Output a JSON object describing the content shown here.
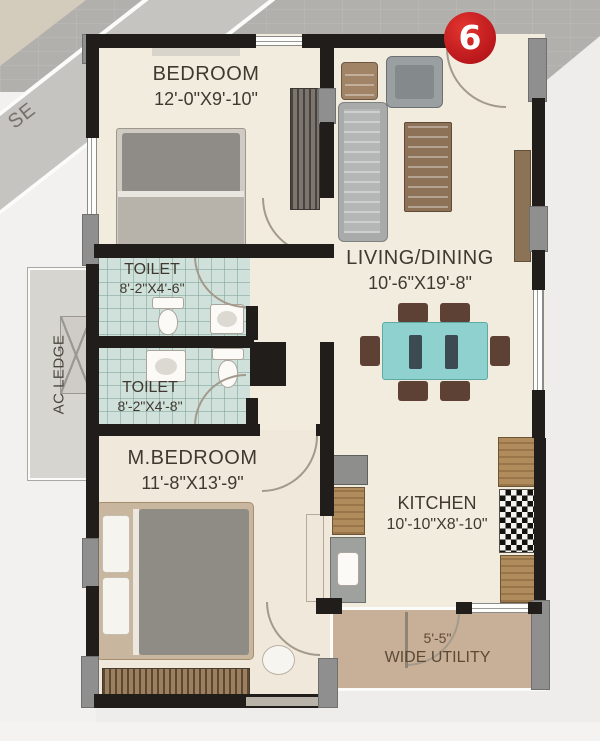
{
  "badge": {
    "number": "6"
  },
  "exterior": {
    "direction_label": "SE",
    "ac_ledge": "AC LEDGE"
  },
  "rooms": {
    "bedroom": {
      "name": "BEDROOM",
      "dims": "12'-0\"X9'-10\""
    },
    "living": {
      "name": "LIVING/DINING",
      "dims": "10'-6\"X19'-8\""
    },
    "toilet1": {
      "name": "TOILET",
      "dims": "8'-2\"X4'-6\""
    },
    "toilet2": {
      "name": "TOILET",
      "dims": "8'-2\"X4'-8\""
    },
    "master_bedroom": {
      "name": "M.BEDROOM",
      "dims": "11'-8\"X13'-9\""
    },
    "kitchen": {
      "name": "KITCHEN",
      "dims": "10'-10\"X8'-10\""
    },
    "utility": {
      "width": "5'-5\"",
      "name": "WIDE UTILITY"
    }
  },
  "colors": {
    "badge_red": "#c8191f",
    "wall": "#201d1a",
    "floor": "#f2ecdf",
    "toilet_tile": "#cfe1da",
    "utility_floor": "#c8b098",
    "dining_table": "#8ed1cf"
  }
}
